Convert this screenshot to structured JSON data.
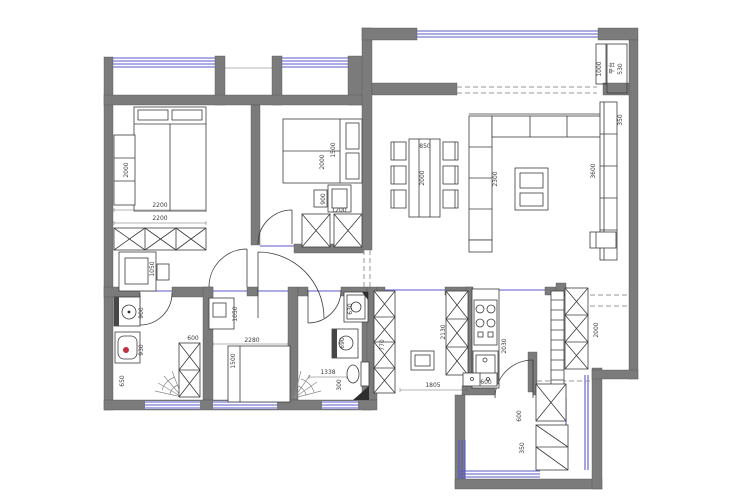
{
  "drawing": {
    "kind": "apartment floor plan",
    "colors": {
      "wall_fill": "#7b7b7b",
      "window_line": "#5a5ac8",
      "furniture_line": "#3c3c3c",
      "dimension_text": "#3d3d3d",
      "dashed_opening": "#979797",
      "toilet_marker_red": "#c03040",
      "background": "#ffffff"
    },
    "symbols": [
      "bed",
      "wardrobe-x-cabinet",
      "desk-with-chair",
      "toilet",
      "wash-basin",
      "shower-spray",
      "washing-machine",
      "dining-table-six-chairs",
      "l-sofa",
      "coffee-table",
      "tv-console",
      "gas-stove",
      "kitchen-sink",
      "stool",
      "door-swing-arc",
      "window-band",
      "dashed-opening"
    ]
  },
  "labels": [
    {
      "text": "2000",
      "x": 128,
      "y": 170,
      "rot": true
    },
    {
      "text": "2200",
      "x": 160,
      "y": 207,
      "rot": false
    },
    {
      "text": "2200",
      "x": 160,
      "y": 220,
      "rot": false
    },
    {
      "text": "1050",
      "x": 154,
      "y": 269,
      "rot": true
    },
    {
      "text": "900",
      "x": 143,
      "y": 313,
      "rot": true
    },
    {
      "text": "930",
      "x": 143,
      "y": 350,
      "rot": true
    },
    {
      "text": "650",
      "x": 124,
      "y": 381,
      "rot": true
    },
    {
      "text": "600",
      "x": 193,
      "y": 340,
      "rot": false
    },
    {
      "text": "1050",
      "x": 237,
      "y": 314,
      "rot": true
    },
    {
      "text": "2280",
      "x": 252,
      "y": 342,
      "rot": false
    },
    {
      "text": "1500",
      "x": 235,
      "y": 361,
      "rot": true
    },
    {
      "text": "2000",
      "x": 324,
      "y": 162,
      "rot": true
    },
    {
      "text": "1500",
      "x": 335,
      "y": 150,
      "rot": true
    },
    {
      "text": "900",
      "x": 325,
      "y": 199,
      "rot": true
    },
    {
      "text": "1200",
      "x": 339,
      "y": 212,
      "rot": false
    },
    {
      "text": "630",
      "x": 352,
      "y": 309,
      "rot": true
    },
    {
      "text": "690",
      "x": 344,
      "y": 343,
      "rot": true
    },
    {
      "text": "1338",
      "x": 328,
      "y": 374,
      "rot": false
    },
    {
      "text": "300",
      "x": 341,
      "y": 385,
      "rot": true
    },
    {
      "text": "850",
      "x": 425,
      "y": 148,
      "rot": false
    },
    {
      "text": "2000",
      "x": 424,
      "y": 178,
      "rot": true
    },
    {
      "text": "2300",
      "x": 497,
      "y": 179,
      "rot": true
    },
    {
      "text": "1000",
      "x": 601,
      "y": 69,
      "rot": true
    },
    {
      "text": "平台",
      "x": 614,
      "y": 68,
      "rot": true
    },
    {
      "text": "530",
      "x": 622,
      "y": 69,
      "rot": true
    },
    {
      "text": "350",
      "x": 622,
      "y": 120,
      "rot": true
    },
    {
      "text": "3600",
      "x": 595,
      "y": 171,
      "rot": true
    },
    {
      "text": "770",
      "x": 384,
      "y": 345,
      "rot": true
    },
    {
      "text": "2130",
      "x": 445,
      "y": 332,
      "rot": true
    },
    {
      "text": "1805",
      "x": 433,
      "y": 387,
      "rot": false
    },
    {
      "text": "2030",
      "x": 506,
      "y": 346,
      "rot": true
    },
    {
      "text": "600",
      "x": 486,
      "y": 384,
      "rot": false
    },
    {
      "text": "2000",
      "x": 598,
      "y": 330,
      "rot": true
    },
    {
      "text": "600",
      "x": 521,
      "y": 416,
      "rot": true
    },
    {
      "text": "350",
      "x": 524,
      "y": 448,
      "rot": true
    }
  ]
}
